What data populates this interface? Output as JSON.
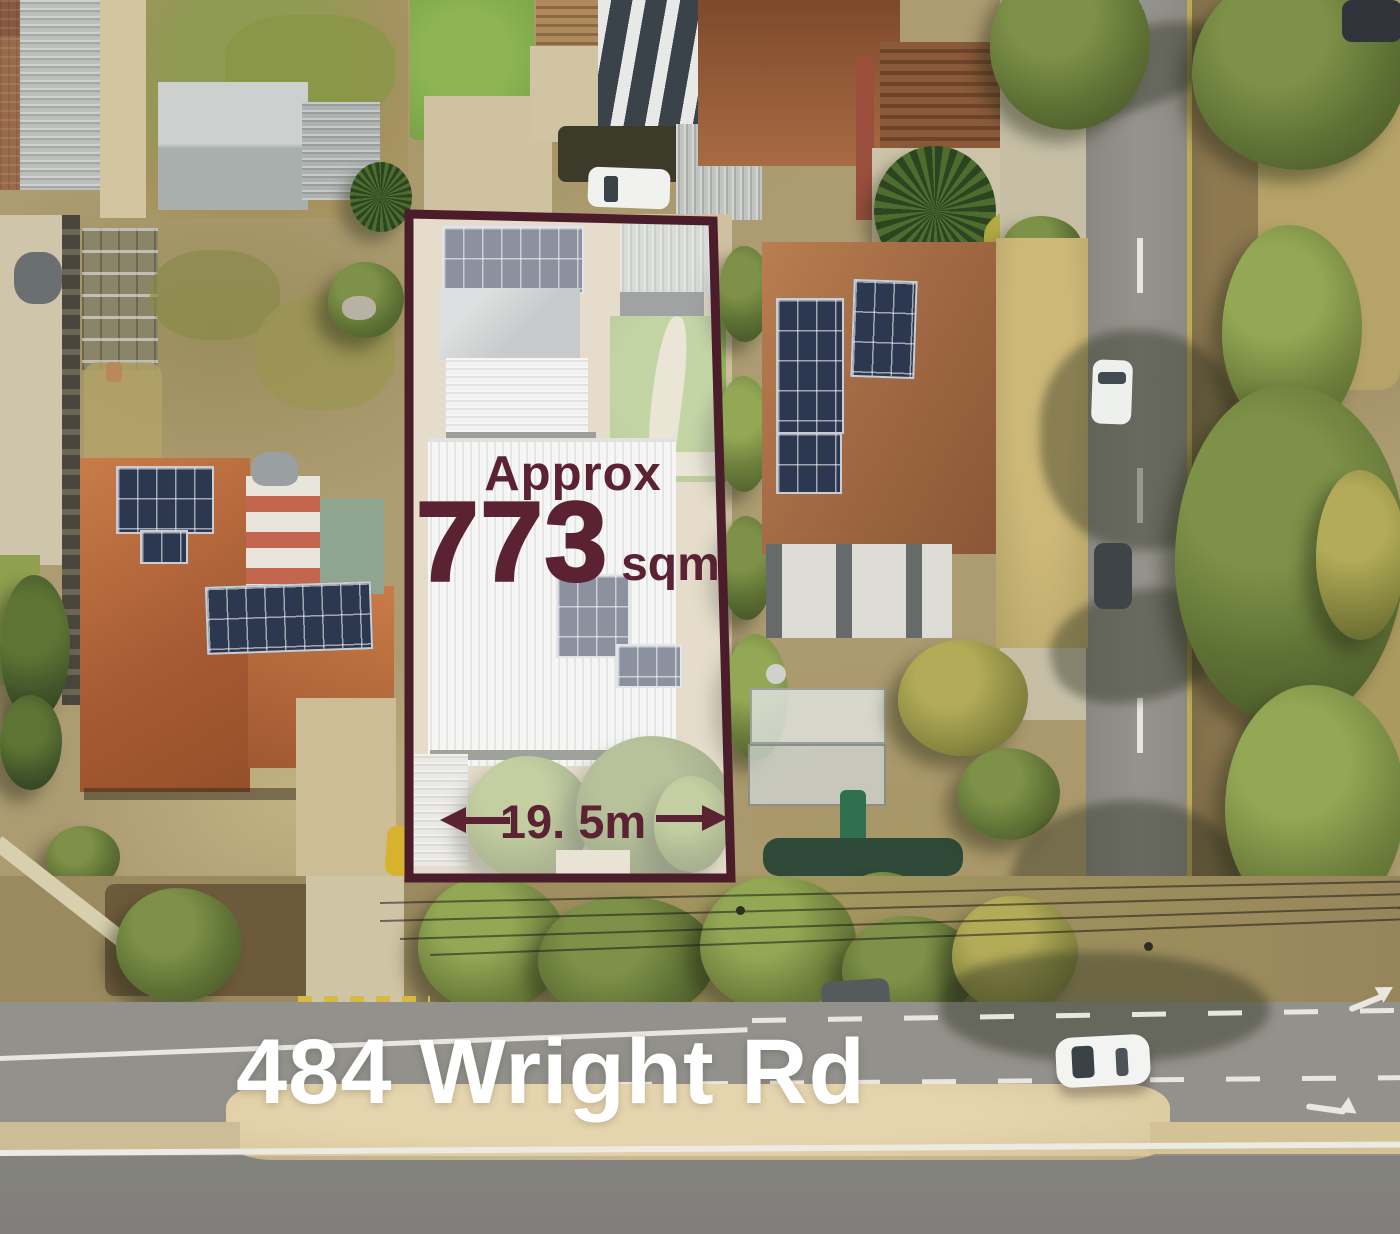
{
  "lot": {
    "area_label_prefix": "Approx",
    "area_value": "773",
    "area_unit": "sqm",
    "frontage_label": "19. 5m",
    "boundary_color": "#4b1c2a"
  },
  "address": {
    "label": "484 Wright Rd"
  },
  "colors": {
    "maroon": "#5a2233",
    "white": "#ffffff",
    "terracotta": "#bd6e41",
    "brownroof": "#a06438",
    "solar": "#2e3c55",
    "lawn": "#7fa74b",
    "olive": "#6d7f3c",
    "roadgray": "#8f8d87",
    "asphalt": "#898781",
    "mediantan": "#dbc89e",
    "sand": "#c9b88f"
  }
}
